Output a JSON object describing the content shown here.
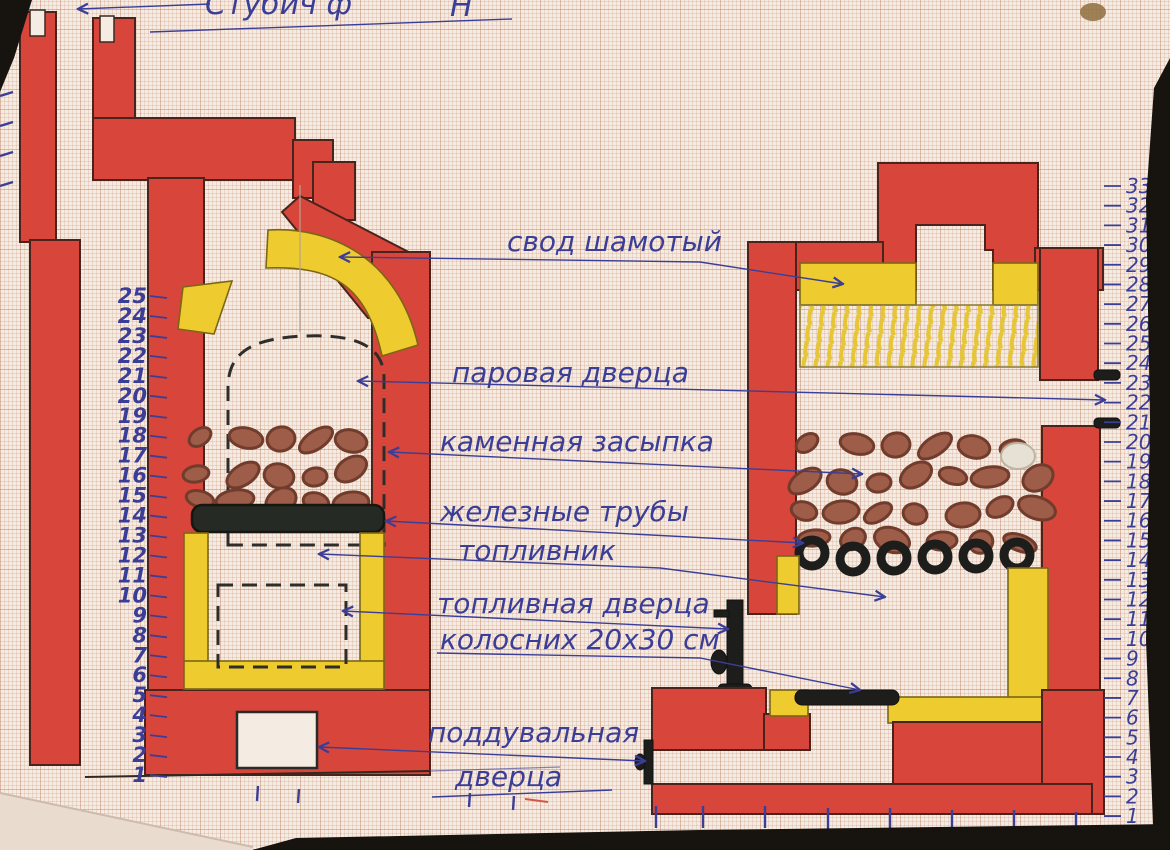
{
  "document": {
    "kind": "hand-drawn stove cross-section diagram on graph paper",
    "top_note": {
      "left_text": "Стубич  ф",
      "right_text": "Н"
    },
    "callouts": {
      "svod": "свод шамотый",
      "parovaya": "паровая дверца",
      "kamennaya": "каменная засыпка",
      "zheleznye": "железные трубы",
      "toplivnik": "топливник",
      "toplivnaya": "топливная дверца",
      "kolosnik": "колосних 20х30 см",
      "podduvalnaya_line1": "поддувальная",
      "podduvalnaya_line2": "дверца"
    },
    "left_ruler": {
      "values": [
        25,
        24,
        23,
        22,
        21,
        20,
        19,
        18,
        17,
        16,
        15,
        14,
        13,
        12,
        11,
        10,
        9,
        8,
        7,
        6,
        5,
        4,
        3,
        2,
        1
      ]
    },
    "right_ruler": {
      "values": [
        33,
        32,
        31,
        30,
        29,
        28,
        27,
        26,
        25,
        24,
        23,
        22,
        21,
        20,
        19,
        18,
        17,
        16,
        15,
        14,
        13,
        12,
        11,
        10,
        9,
        8,
        7,
        6,
        5,
        4,
        3,
        2,
        1
      ]
    },
    "pipes": {
      "count": 6
    },
    "stones": {
      "left_count": 15,
      "right_count": 26
    },
    "colors": {
      "paper": "#f4ebe2",
      "brick_red": "#d8453a",
      "outline": "#4a241c",
      "fireclay_yellow": "#eecb2f",
      "ink_blue": "#3b3e96",
      "stone_brown": "#9e5d49",
      "stone_edge": "#713c2c",
      "metal_black": "#1d1d1b"
    }
  }
}
